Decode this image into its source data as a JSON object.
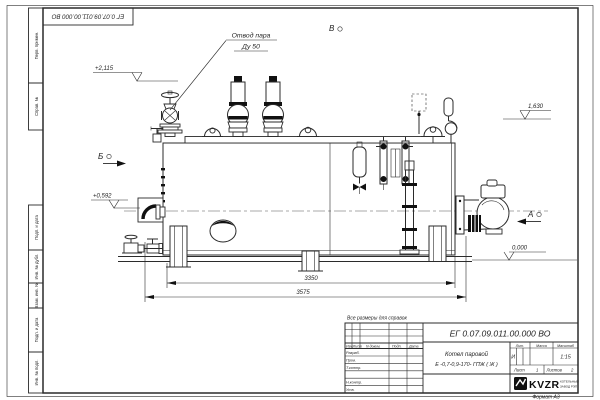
{
  "page": {
    "corner_stamp": "ЕГ 0.07.09.011.00.000  ВО",
    "note": "Все размеры для справок",
    "format_label": "Формат А3"
  },
  "margin_labels": {
    "m1": "Перв. примен.",
    "m2": "Справ. №",
    "m3": "Подп. и дата",
    "m4": "Инв. № дубл.",
    "m5": "Взам. инв. №",
    "m6": "Подп. и дата",
    "m7": "Инв. № подл."
  },
  "annotations": {
    "callout_line1": "Отвод пара",
    "callout_line2": "Ду 50",
    "view_top": "В",
    "view_left": "Б",
    "view_right": "А",
    "elev_top_left": "+2,115",
    "elev_mid_left": "+0,592",
    "elev_top_right": "1,630",
    "elev_zero": "0,000"
  },
  "dimensions": {
    "inner": "3350",
    "overall": "3575"
  },
  "title_block": {
    "doc_number": "ЕГ 0.07.09.011.00.000  ВО",
    "name_line1": "Котел паровой",
    "name_line2": "Е -0,7-0,9-170- ГПЖ ( Ж )",
    "col_izm": "Изм.",
    "col_list": "Лист",
    "col_doc": "N докум.",
    "col_podp": "Подп.",
    "col_data": "Дата",
    "row_razrab": "Разраб.",
    "row_prov": "Пров.",
    "row_tkontr": "Т.контр.",
    "row_nkontr": "Н.контр.",
    "row_utv": "Утв.",
    "lit_label": "Лит.",
    "lit_value": "И",
    "mass_label": "Масса",
    "scale_label": "Масштаб",
    "scale_value": "1:15",
    "sheet_label": "Лист",
    "sheet_value": "1",
    "sheets_label": "Листов",
    "sheets_value": "2",
    "brand": "KVZR",
    "brand_line1": "КОТЕЛЬНЫЙ",
    "brand_line2": "ЗАВОД РЭП"
  }
}
